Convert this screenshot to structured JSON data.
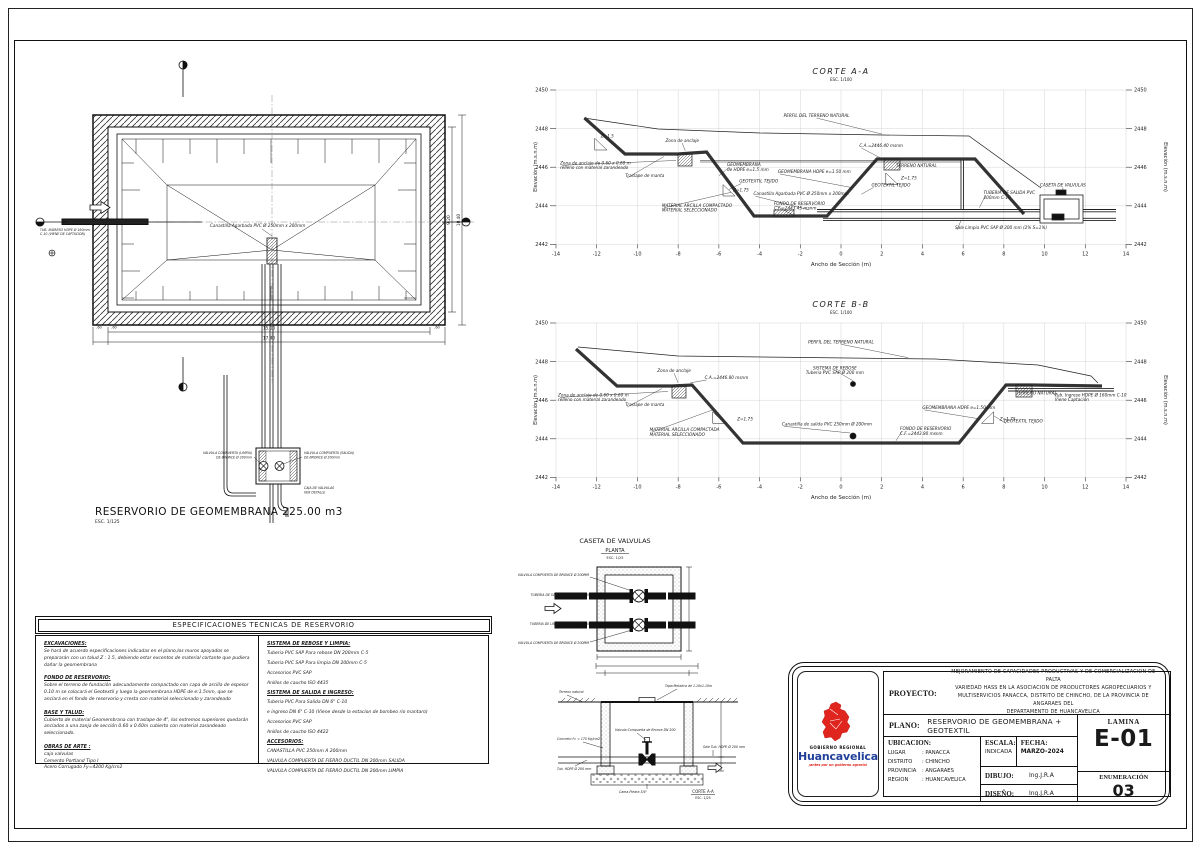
{
  "plan": {
    "title": "RESERVORIO DE GEOMEMBRANA 225.00 m3",
    "scale": "ESC. 1/125",
    "inlet_l1": "TUB. INGRESO HDPE Ø 160mm",
    "inlet_l2": "C-10 (VIENE DE CAPTACION)",
    "canastilla_label": "Canastilla Agarbada PVC Ø 250mm x 200mm",
    "valve_left_l1": "VALVULA COMPUERTA (LIMPIA)",
    "valve_left_l2": "DE BRONCE Ø 200mm",
    "valve_right_l1": "VALVULA COMPUERTA (SALIDA)",
    "valve_right_l2": "DE BRONCE Ø 200mm",
    "valve_below_l1": "CAJA DE VALVULAS",
    "valve_below_l2": "VER DETALLE",
    "dims": {
      "w_in": "15.00",
      "w_out": "17.40",
      "h_in": "9.20",
      "h_out": "10.40",
      "a": ".60",
      "b": ".60",
      "c": ".60"
    }
  },
  "corte_a": {
    "title": "CORTE A-A",
    "scale": "ESC. 1/100",
    "xlabel": "Ancho de Sección (m)",
    "ylabel": "Elevación (m.s.n.m)",
    "x_ticks": [
      -14,
      -12,
      -10,
      -8,
      -6,
      -4,
      -2,
      0,
      2,
      4,
      6,
      8,
      10,
      12,
      14
    ],
    "y_ticks": [
      2450,
      2448,
      2446,
      2444,
      2442
    ],
    "annotations": [
      "PERFIL DEL TERRENO NATURAL",
      "Zona de anclaje",
      "Zona de anclaje de 0.60 x 0.60 m\nrelleno con material zarandeado",
      "Traslape de manta",
      "GEOMEMBRANA\nde HDPE e=1.5 mm",
      "GEOTEXTIL TEJIDO",
      "GEOMEMBRANA HDPE e=1.50 mm",
      "Canastilla Agarbada PVC Ø 250mm x 200mm",
      "FONDO DE RESERVORIO\nC.F.=2443.45 msnm",
      "MATERIAL ARCILLA COMPACTADO\nMATERIAL SELECCIONADO",
      "C.A.=2446.40 msnm",
      "TERRENO NATURAL",
      "GEOTEXTIL TEJIDO",
      "Z=1.5",
      "Z=1.75",
      "Z=1.75",
      "TUBERIA DE SALIDA PVC\n200mm C-10",
      "Sale Limpia PVC SAP Ø 200 mm (2% S=1%)",
      "CASETA DE VALVULAS"
    ]
  },
  "corte_b": {
    "title": "CORTE B-B",
    "scale": "ESC. 1/100",
    "xlabel": "Ancho de Sección (m)",
    "ylabel": "Elevación (m.s.n.m)",
    "x_ticks": [
      -14,
      -12,
      -10,
      -8,
      -6,
      -4,
      -2,
      0,
      2,
      4,
      6,
      8,
      10,
      12,
      14
    ],
    "y_ticks": [
      2450,
      2448,
      2446,
      2444,
      2442
    ],
    "annotations": [
      "PERFIL DEL TERRENO NATURAL",
      "SISTEMA DE REBOSE\nTuberia PVC SAP Ø 200 mm",
      "Zona de anclaje",
      "C.A.=2446.80 msnm",
      "Zona de anclaje de 0.60 x 0.60 m\nrelleno con material zarandeado",
      "Traslape de manta",
      "MATERIAL ARCILLA COMPACTADA\nMATERIAL SELECCIONADO",
      "Z=1.75",
      "Z=1.75",
      "Canastilla de salida PVC 250mm Ø 200mm",
      "FONDO DE RESERVORIO\nC.F.=2443.80 msnm",
      "GEOMEMBRANA HDPE e=1.50 mm",
      "GEOTEXTIL TEJIDO",
      "TERRENO NATURAL",
      "Tub. Ingreso HDPE Ø 160mm C-10\nViene Captación"
    ]
  },
  "caseta_plan": {
    "title": "CASETA DE VALVULAS",
    "subtitle": "PLANTA",
    "scale": "ESC. 1/25",
    "labels": {
      "valve_top": "VALVULA COMPUERTA DE BRONCE Ø 200MM",
      "pipe_out": "TUBERIA DE SALIDA DE 200MM C-10",
      "pipe_clean": "TUBERIA DE LIMPIA DE 160 mm C-10",
      "valve_bottom": "VALVULA COMPUERTA DE BRONCE Ø 200MM"
    }
  },
  "caseta_corte": {
    "title": "CORTE A-A",
    "scale": "ESC. 1/25",
    "labels": {
      "terreno": "Terreno natural",
      "tapa": "Tapa Metalica de 1.10x1.10m",
      "valvula": "Valvula Compuerta de Bronce DN 200",
      "concreto": "Concreto f'c = 175 Kg/cm2",
      "tub": "Tub. HDPE Ø 200 mm",
      "cama": "Cama-Piedra 3/4\"",
      "salida": "Sale Tub. HDPE Ø 200 mm"
    }
  },
  "specs": {
    "title": "ESPECIFICACIONES TECNICAS DE RESERVORIO",
    "left": [
      {
        "head": "EXCAVACIONES:",
        "body": "Se hará de acuerdo especificaciones indicadas en el plano,los muros apoyados se prepararán con un talud Z : 1.5, debiendo estar excentos de material cortante que pudiera dañar la geomembrana"
      },
      {
        "head": "FONDO DE RESERVORIO:",
        "body": "Sobre el terreno de fundación adecuadamente compactado con capa de arcilla de espesor 0.10 m se colocará el Geotextil y luego la geomembrana HDPE de e:1.5mm, que se anclará en el fondo de reservorio y cresta con material seleccionado y zarandeado"
      },
      {
        "head": "BASE Y TALUD:",
        "body": "Cubierto de material Geomembrana con traslape de 4\", los extremos superiores quedarán anclados a una zanja de sección  0.60 x 0.60m cubierto con material zarandeado seleccionado."
      },
      {
        "head": "OBRAS DE ARTE :",
        "body": "caja valvulas\nCemento Portland Tipo I\nAcero Corrugado Fy=4200 Kg/cm2"
      }
    ],
    "right": [
      {
        "head": "SISTEMA DE REBOSE Y LIMPIA:",
        "items": [
          "Tuberia PVC SAP Para rebose DN 200mm C-5",
          "Tuberia PVC SAP Para limpia DN 200mm C-5",
          "Accesorios PVC SAP",
          "Anillos de caucho ISO 4435"
        ]
      },
      {
        "head": "SISTEMA DE SALIDA E INGRESO:",
        "items": [
          "Tuberia PVC Para Salida DN 6\" C-10",
          "e ingreso DN 6\" C-10 (Viene desde la estacion de bombeo rio mantaro)",
          "Accesorios PVC SAP",
          "Anillos de caucho ISO 4422"
        ]
      },
      {
        "head": "ACCESORIOS:",
        "items": [
          "CANASTILLA PVC 250mm A 200mm",
          "VALVULA COMPUERTA DE FIERRO DUCTIL DN 200mm SALIDA",
          "VALVULA COMPUERTA DE FIERRO DUCTIL DN 200mm LIMPIA"
        ]
      }
    ]
  },
  "titleblock": {
    "proyecto_label": "PROYECTO:",
    "proyecto_lines": [
      "MEJORAMIENTO DE CAPACIDADES PRODUCTIVAS Y DE COMERCIALIZACION DE PALTA",
      "VARIEDAD HASS EN LA ASOCIACION DE PRODUCTORES AGROPECUARIOS Y",
      "MULTISERVICIOS PANACCA, DISTRITO DE CHINCHO, DE LA PROVINCIA DE ANGARAES DEL",
      "DEPARTAMENTO DE HUANCAVELICA"
    ],
    "plano_label": "PLANO:",
    "plano_value": "RESERVORIO DE GEOMEMBRANA + GEOTEXTIL",
    "ubicacion_label": "UBICACION:",
    "ubicacion_rows": [
      {
        "l": "LUGAR",
        "v": ": PANACCA"
      },
      {
        "l": "DISTRITO",
        "v": ": CHINCHO"
      },
      {
        "l": "PROVINCIA",
        "v": ": ANGARAES"
      },
      {
        "l": "REGION",
        "v": ": HUANCAVELICA"
      }
    ],
    "escala_label": "ESCALA:",
    "escala_value": "INDICADA",
    "fecha_label": "FECHA:",
    "fecha_value": "MARZO-2024",
    "dibujo_label": "DIBUJO:",
    "dibujo_value": "Ing.J.R.A",
    "diseno_label": "DISEÑO:",
    "diseno_value": "Ing.J.R.A",
    "lamina_label": "LAMINA",
    "lamina_value": "E-01",
    "enum_label": "ENUMERACIÓN",
    "enum_value": "03"
  },
  "logo": {
    "line1": "GOBIERNO REGIONAL",
    "line2": "Huancavelica",
    "tagline": "¡antes por un gobierno agrario!",
    "red": "#e0251f",
    "blue": "#21409a"
  }
}
